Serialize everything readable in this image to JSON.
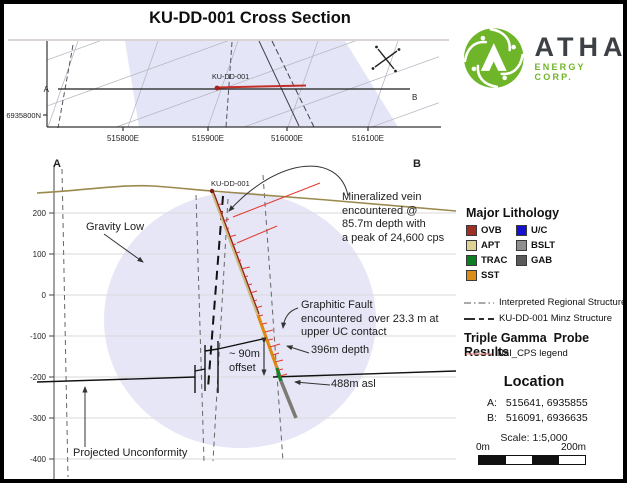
{
  "title": "KU-DD-001 Cross Section",
  "logo": {
    "name": "ATHA",
    "subtitle": "ENERGY CORP.",
    "green": "#6fb52a",
    "text_color": "#3d4045"
  },
  "colors": {
    "lavender": "#dfe0f4",
    "topo_line": "#9b8a4e",
    "gamma_red": "#e23b2d",
    "probe_line": "#e8908f"
  },
  "plan": {
    "a": "A",
    "b": "B",
    "hole": "KU-DD-001",
    "northing": "6935800N",
    "eastings": [
      "515800E",
      "515900E",
      "516000E",
      "516100E"
    ]
  },
  "section": {
    "a": "A",
    "b": "B",
    "hole": "KU-DD-001",
    "elev": [
      "200",
      "100",
      "0",
      "-100",
      "-200",
      "-300",
      "-400"
    ]
  },
  "annotations": {
    "gravity_low": "Gravity Low",
    "mineralized_vein": "Mineralized vein\nencountered @\n85.7m depth with\na peak of 24,600 cps",
    "graphitic_fault": "Graphitic Fault\nencountered  over 23.3 m at\nupper UC contact",
    "offset": "~ 90m\noffset",
    "depth": "396m depth",
    "asl": "488m asl",
    "projected_unconformity": "Projected Unconformity"
  },
  "legend": {
    "lithology_title": "Major Lithology",
    "lithology": [
      {
        "label": "OVB",
        "color": "#9e2f26"
      },
      {
        "label": "U/C",
        "color": "#1412cf"
      },
      {
        "label": "APT",
        "color": "#ded395"
      },
      {
        "label": "BSLT",
        "color": "#8f8f8f"
      },
      {
        "label": "TRAC",
        "color": "#0c7d22"
      },
      {
        "label": "GAB",
        "color": "#595959"
      },
      {
        "label": "SST",
        "color": "#d98f17"
      }
    ],
    "structure_items": [
      {
        "label": "Interpreted Regional Structure"
      },
      {
        "label": "KU-DD-001 Minz Structure"
      }
    ],
    "gamma_title": "Triple Gamma  Probe Results",
    "gamma_item": "NaI_CPS legend",
    "location_title": "Location",
    "loc_a_label": "A:",
    "loc_a": "515641, 6935855",
    "loc_b_label": "B:",
    "loc_b": "516091, 6936635",
    "scale_text": "Scale: 1:5,000",
    "scale_left": "0m",
    "scale_right": "200m"
  }
}
